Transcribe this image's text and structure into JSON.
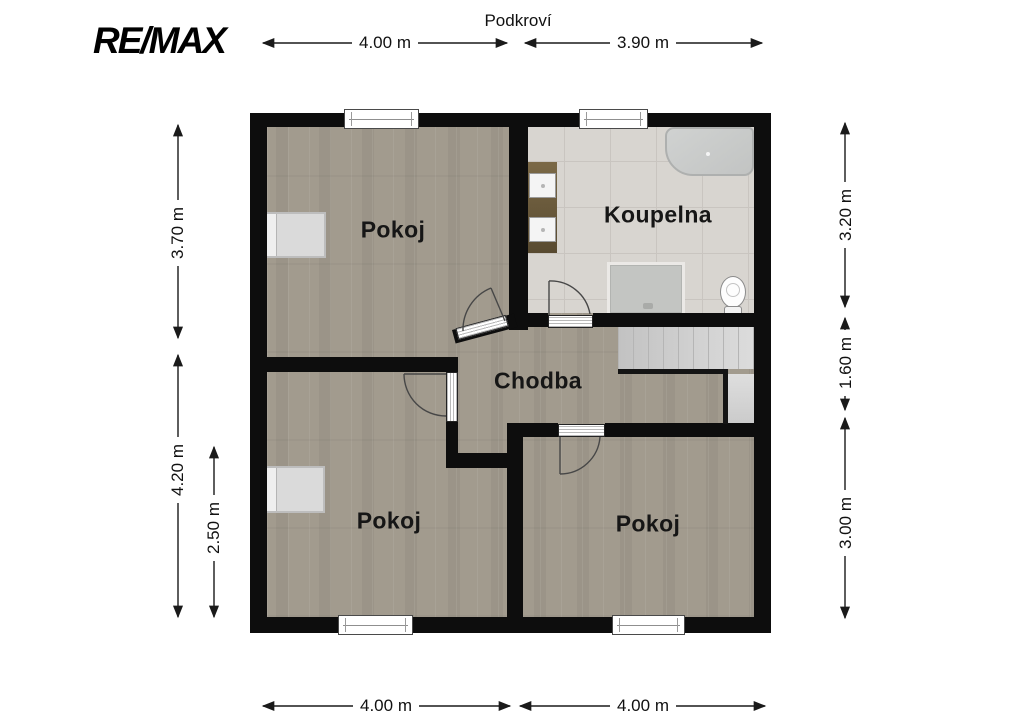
{
  "header": {
    "logo_text": "RE/MAX",
    "plan_title": "Podkroví"
  },
  "rooms": {
    "room_top_left": "Pokoj",
    "bathroom": "Koupelna",
    "hallway": "Chodba",
    "room_bottom_left": "Pokoj",
    "room_bottom_right": "Pokoj"
  },
  "dimensions": {
    "top_width_left": "4.00 m",
    "top_width_right": "3.90 m",
    "bottom_width_left": "4.00 m",
    "bottom_width_right": "4.00 m",
    "left_height_top": "3.70 m",
    "left_height_bottom": "4.20 m",
    "left_height_inner": "2.50 m",
    "right_height_top": "3.20 m",
    "right_height_middle": "1.60 m",
    "right_height_bottom": "3.00 m"
  },
  "colors": {
    "wall": "#0d0d0d",
    "wood_floor": "#a29b8e",
    "tile_floor": "#d8d5d0",
    "stairs": "#cfcfcf",
    "dimension_line": "#1a1a1a"
  }
}
